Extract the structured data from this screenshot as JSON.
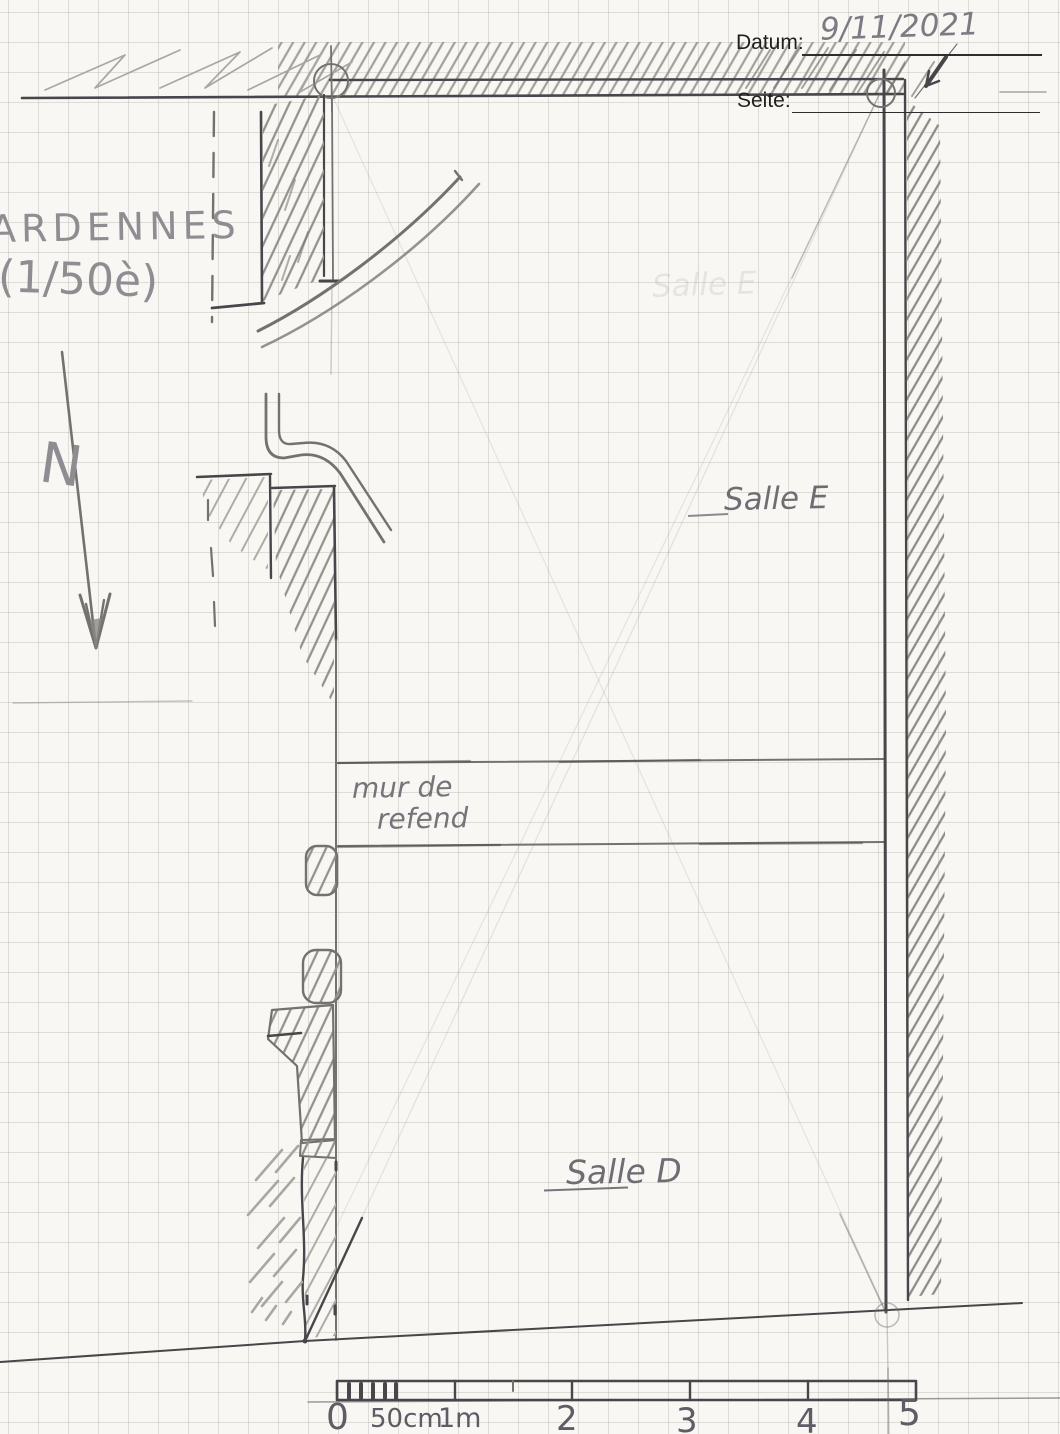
{
  "header": {
    "date_label": "Datum:",
    "date_value": "9/11/2021",
    "page_label": "Seite:"
  },
  "annotations": {
    "site_name": "ARDENNES",
    "scale_note": "(1/50è)",
    "north": "N",
    "room_upper": "Salle E",
    "room_upper_ghost": "Salle E",
    "room_lower": "Salle D",
    "partition_line1": "mur de",
    "partition_line2": "refend"
  },
  "scale_bar": {
    "ticks": [
      "0",
      "50cm",
      "1m",
      "2",
      "3",
      "4",
      "5"
    ]
  },
  "colors": {
    "paper": "#f8f7f3",
    "grid_line": "#97958d",
    "pencil_dark": "#47464a",
    "pencil_mid": "#74726e",
    "pencil_light": "#a9a7a1",
    "printed_text": "#1f1f1f"
  }
}
